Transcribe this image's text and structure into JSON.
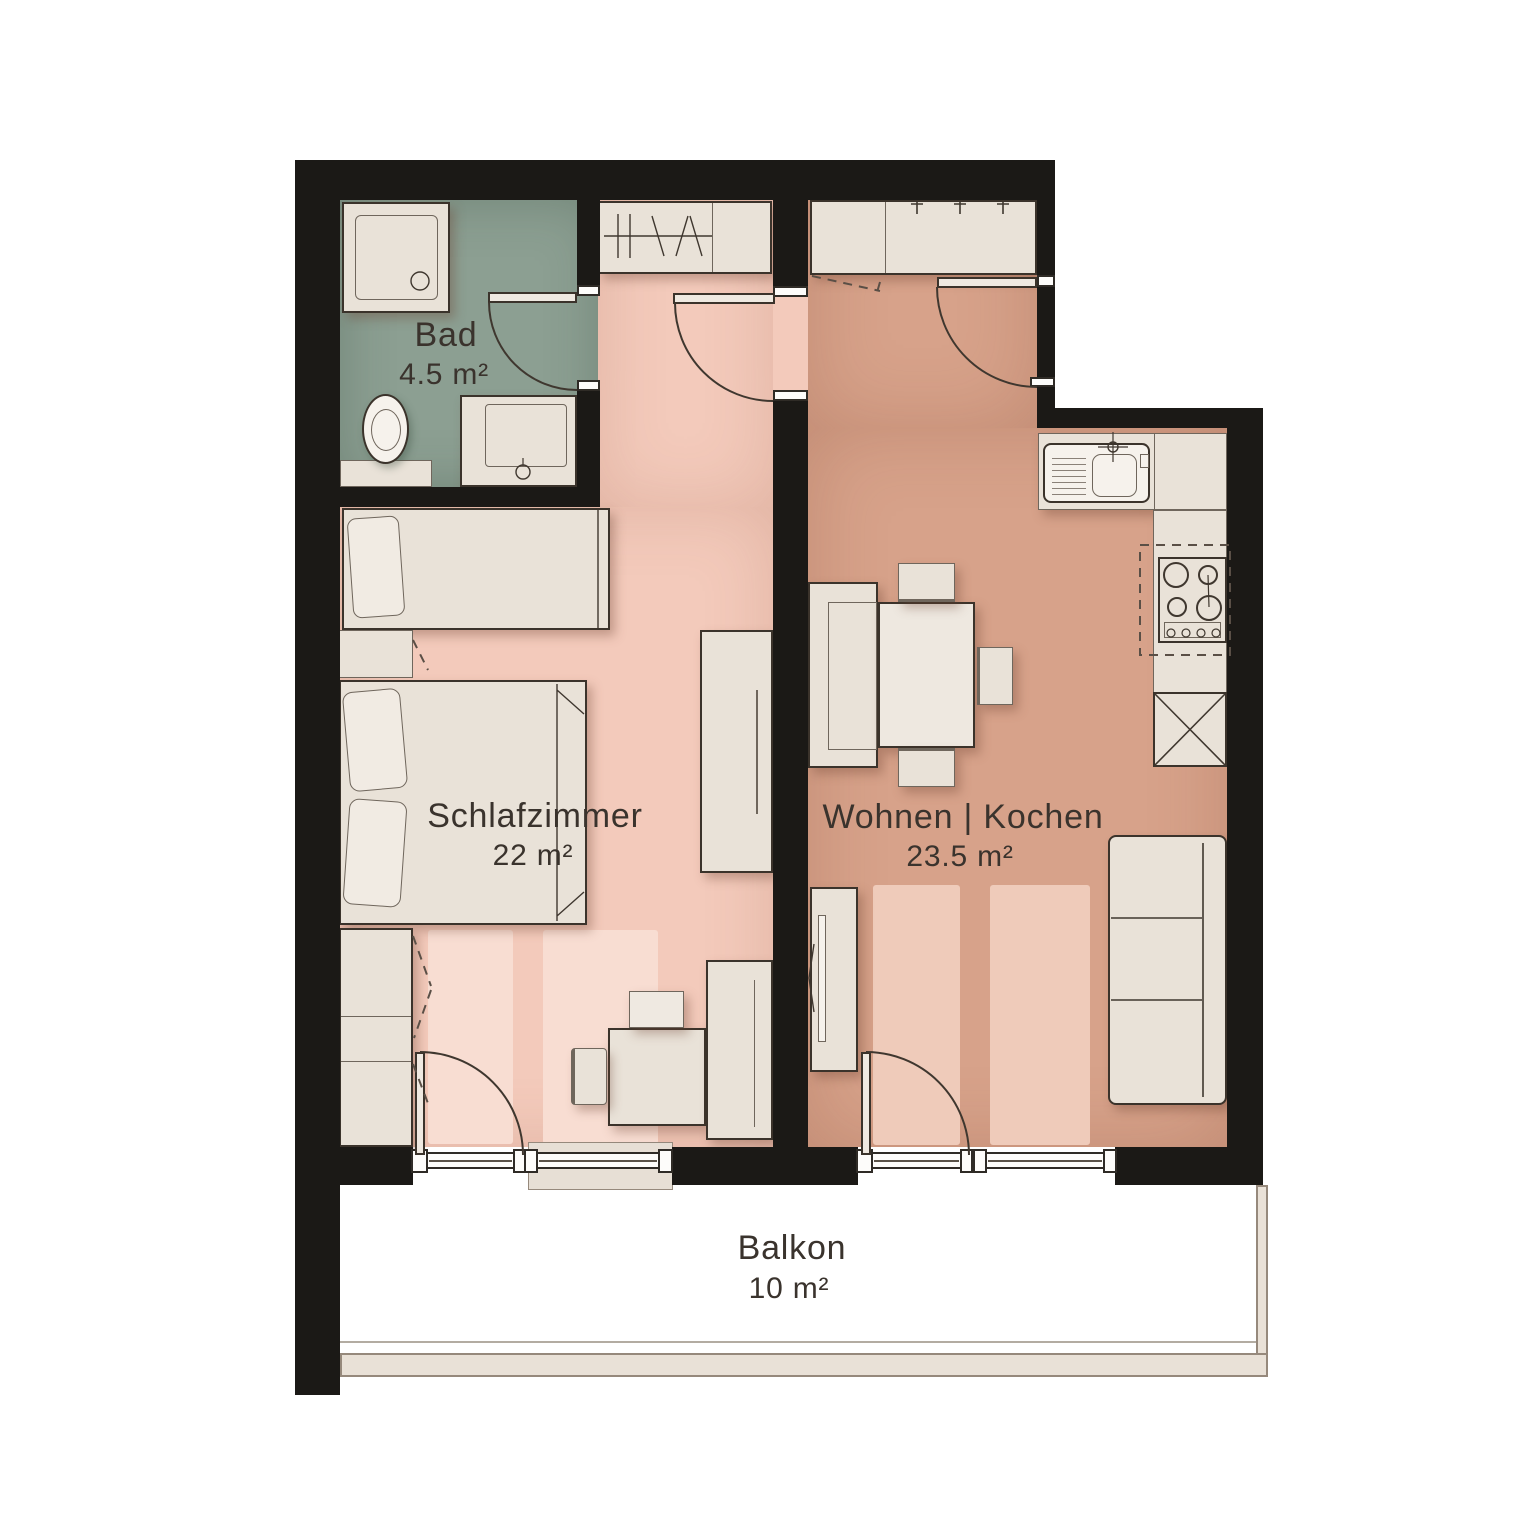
{
  "rooms": {
    "bad": {
      "label": "Bad",
      "area": "4.5 m²"
    },
    "schlafzimmer": {
      "label": "Schlafzimmer",
      "area": "22 m²"
    },
    "wohnen_kochen": {
      "label": "Wohnen | Kochen",
      "area": "23.5 m²"
    },
    "balkon": {
      "label": "Balkon",
      "area": "10 m²"
    }
  },
  "colors": {
    "wall": "#1b1916",
    "bedroom_floor": "#f3cabb",
    "living_floor": "#d7a28a",
    "bathroom_floor": "#8c9f92",
    "balcony_floor": "#ffffff",
    "furniture": "#e9e2d8",
    "outline": "#3b332b",
    "text": "#3a332d"
  }
}
